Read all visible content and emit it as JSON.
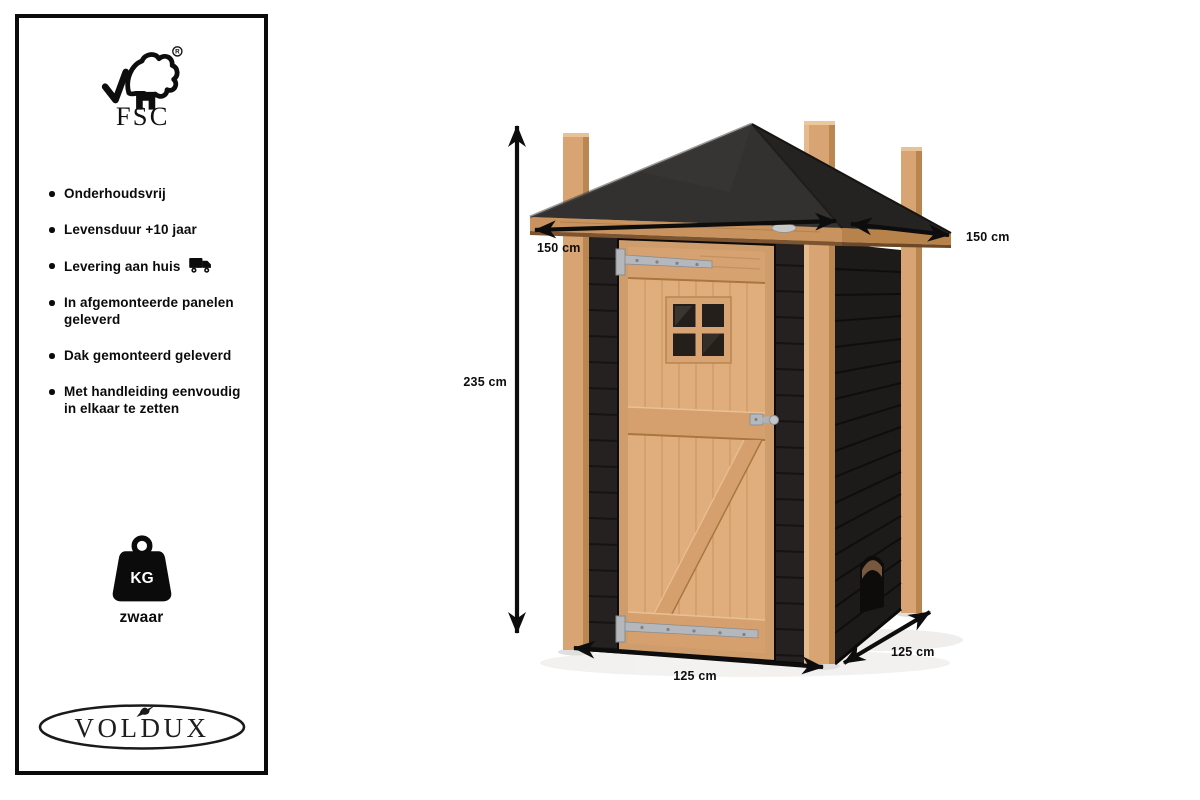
{
  "panel": {
    "certification": {
      "name": "FSC",
      "registered_mark": "R"
    },
    "features": [
      {
        "text": "Onderhoudsvrij"
      },
      {
        "text": "Levensduur +10 jaar"
      },
      {
        "text": "Levering aan huis",
        "icon": "truck-icon"
      },
      {
        "text": "In afgemonteerde panelen\ngeleverd"
      },
      {
        "text": "Dak gemonteerd geleverd"
      },
      {
        "text": "Met handleiding eenvoudig\nin elkaar te zetten"
      }
    ],
    "weight": {
      "unit": "KG",
      "caption": "zwaar",
      "icon": "weight-icon"
    },
    "brand": {
      "name": "VOLDUX"
    }
  },
  "diagram": {
    "dimensions": {
      "height": {
        "label": "235 cm"
      },
      "roof_front": {
        "label": "150 cm"
      },
      "roof_side": {
        "label": "150 cm"
      },
      "base_front": {
        "label": "125 cm"
      },
      "base_side": {
        "label": "125 cm"
      }
    }
  },
  "colors": {
    "ink": "#0d0d0d",
    "roof_front": "#333130",
    "roof_side": "#252321",
    "wood": "#d9a474",
    "wood_shade": "#bb8751",
    "fascia": "#c9935f",
    "fascia_side": "#b8824b",
    "wall_front": "#242120",
    "wall_side": "#1d1b19",
    "door": "#e0ae7d",
    "door_rail": "#d6a06e",
    "metal": "#b4b8bc"
  }
}
